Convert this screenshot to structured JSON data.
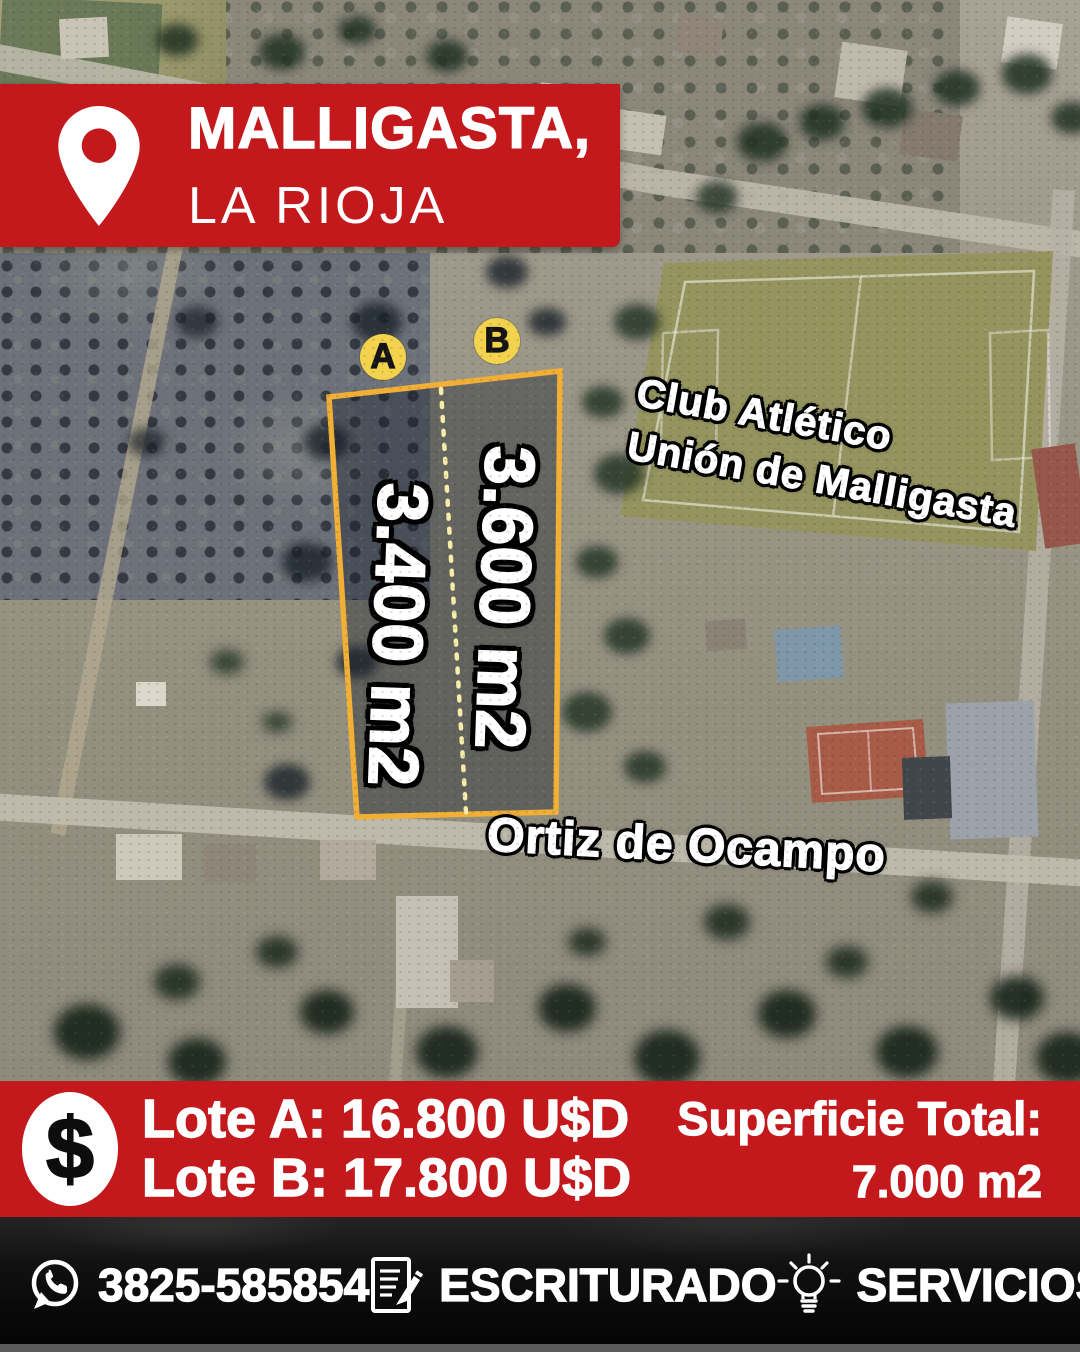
{
  "location_banner": {
    "city": "MALLIGASTA,",
    "province": "LA RIOJA"
  },
  "map_labels": {
    "lot_a_badge": "A",
    "lot_b_badge": "B",
    "lot_a_area": "3.400 m2",
    "lot_b_area": "3.600 m2",
    "club_line1": "Club Atlético",
    "club_line2": "Unión de Malligasta",
    "street": "Ortiz de Ocampo"
  },
  "price_banner": {
    "currency_symbol": "$",
    "lot_a_price": "Lote A: 16.800 U$D",
    "lot_b_price": "Lote B: 17.800 U$D",
    "total_label": "Superficie Total:",
    "total_value": "7.000 m2"
  },
  "footer": {
    "phone": "3825-585854",
    "feature_1": "ESCRITURADO",
    "feature_2": "SERVICIOS"
  },
  "icons": {
    "location_pin": "location-pin-icon",
    "dollar": "dollar-icon",
    "whatsapp": "whatsapp-icon",
    "document_pencil": "document-pencil-icon",
    "lightbulb": "lightbulb-icon"
  },
  "colors": {
    "banner_red": "#C3191C",
    "lot_outline_yellow": "#F2AF35",
    "lot_divider_yellow": "#F8ECA9",
    "badge_yellow": "#F3D24D",
    "text_white": "#FFFFFF",
    "footer_black": "#0A0A0A"
  }
}
